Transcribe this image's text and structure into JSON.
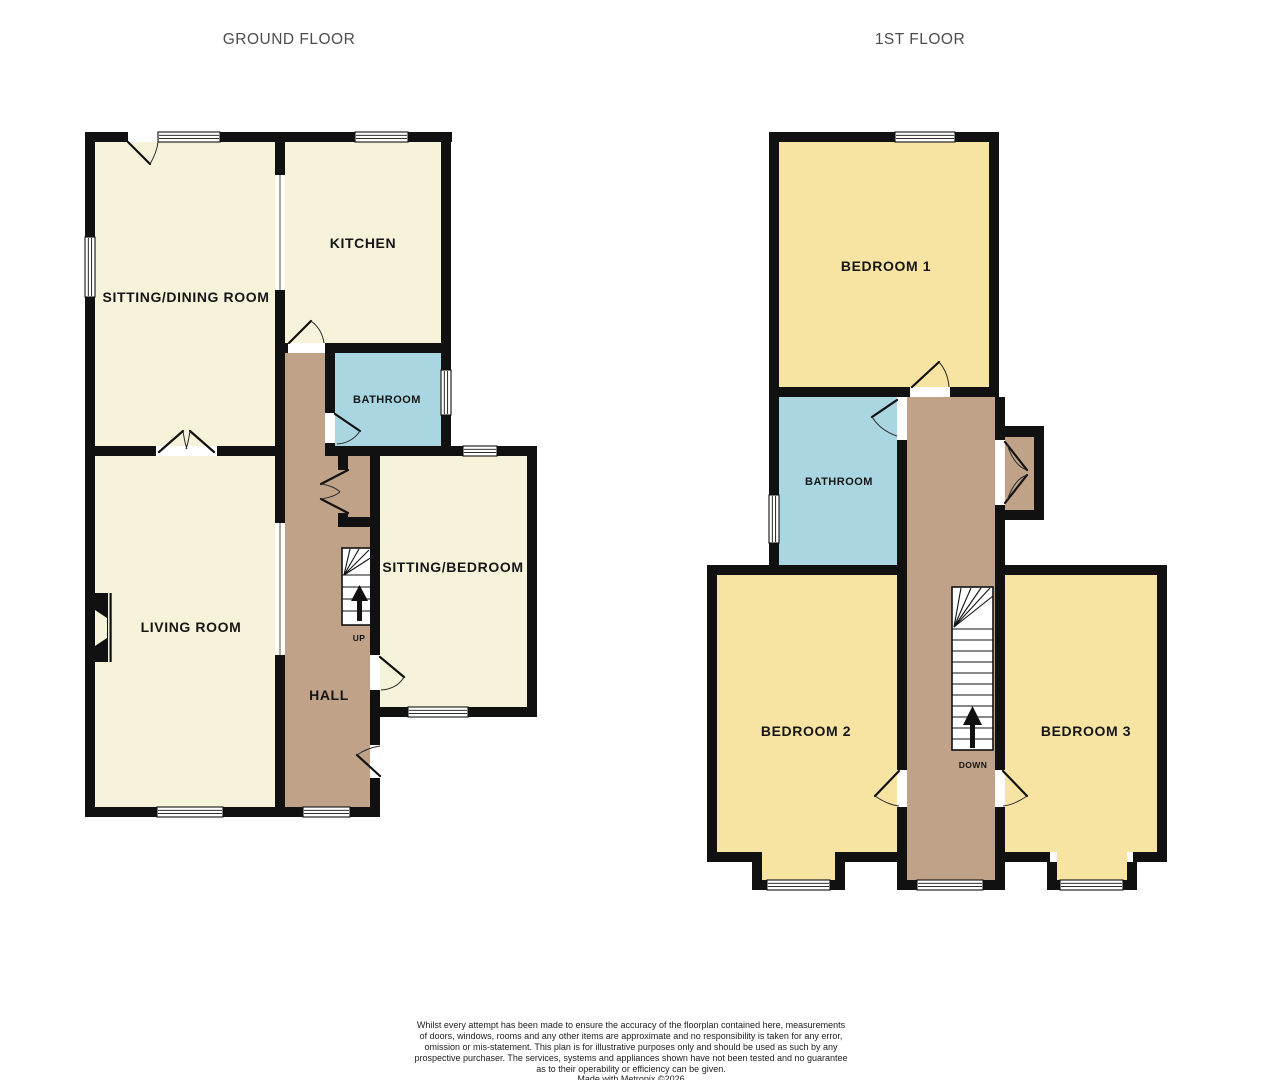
{
  "ground_floor": {
    "title": "GROUND FLOOR",
    "rooms": {
      "sitting_dining": {
        "label": "SITTING/DINING ROOM"
      },
      "kitchen": {
        "label": "KITCHEN"
      },
      "bathroom": {
        "label": "BATHROOM"
      },
      "sitting_bedroom": {
        "label": "SITTING/BEDROOM"
      },
      "living": {
        "label": "LIVING ROOM"
      },
      "hall": {
        "label": "HALL"
      }
    },
    "stairs": {
      "direction_label": "UP"
    }
  },
  "first_floor": {
    "title": "1ST FLOOR",
    "rooms": {
      "bedroom1": {
        "label": "BEDROOM 1"
      },
      "bathroom": {
        "label": "BATHROOM"
      },
      "bedroom2": {
        "label": "BEDROOM 2"
      },
      "bedroom3": {
        "label": "BEDROOM 3"
      }
    },
    "stairs": {
      "direction_label": "DOWN"
    }
  },
  "disclaimer": {
    "lines": [
      "Whilst every attempt has been made to ensure the accuracy of the floorplan contained here, measurements",
      "of doors, windows, rooms and any other items are approximate and no responsibility is taken for any error,",
      "omission or mis-statement. This plan is for illustrative purposes only and should be used as such by any",
      "prospective purchaser. The services, systems and appliances shown have not been tested and no guarantee",
      "as to their operability or efficiency can be given."
    ],
    "credit": "Made with Metropix ©2026"
  },
  "colors": {
    "room_cream": "#f7f2da",
    "room_yellow": "#f7e3a2",
    "room_blue": "#aad6e1",
    "hall_brown": "#bfa287",
    "wall": "#111111",
    "title_text": "#4d4d4d",
    "label_text": "#161616",
    "disclaimer_text": "#1c1c1c"
  }
}
